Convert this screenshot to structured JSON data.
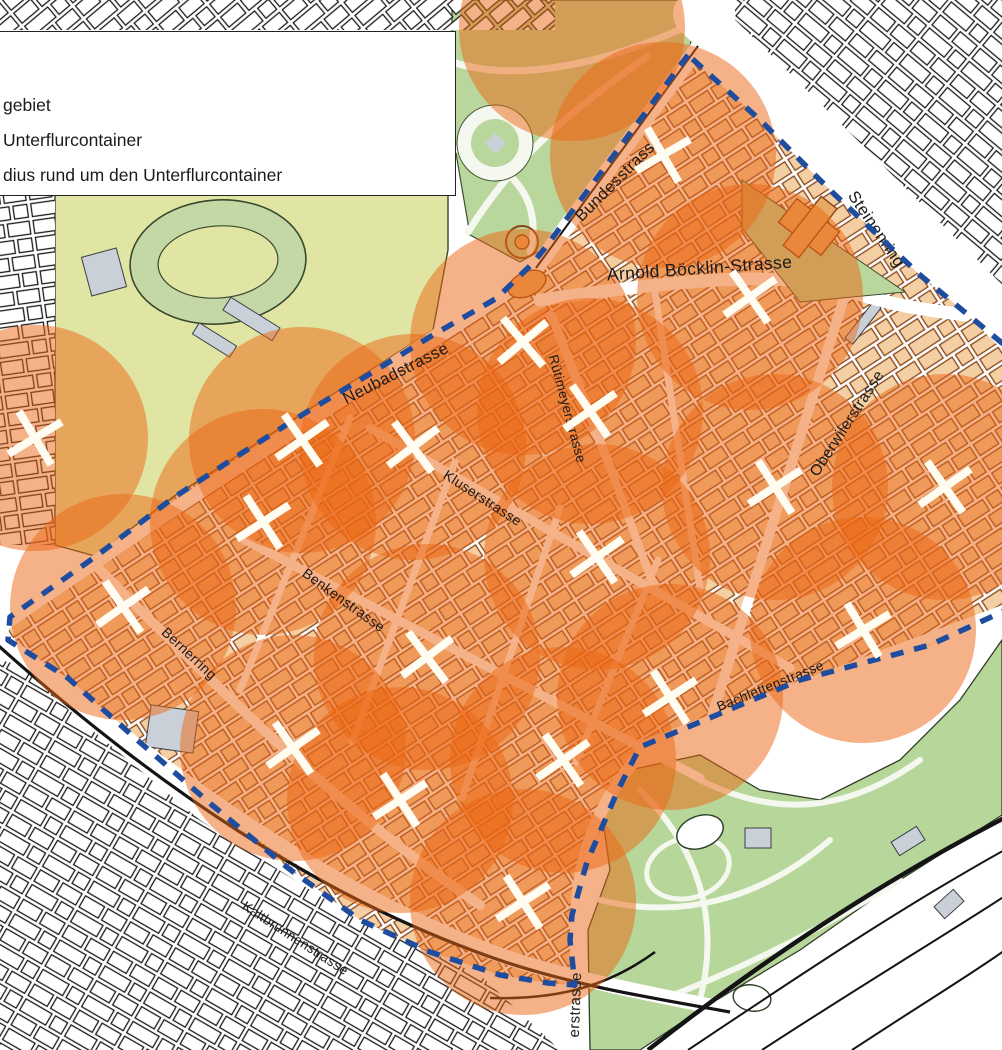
{
  "title": "Unterflurcontainer Pilotgebiet Karte",
  "legend": {
    "lines": [
      {
        "id": "pilot-area",
        "text": "gebiet"
      },
      {
        "id": "container",
        "text": "Unterflurcontainer"
      },
      {
        "id": "radius",
        "text": "dius rund um den Unterflurcontainer"
      }
    ]
  },
  "colors": {
    "circle_fill": "rgba(235,102,18,0.5)",
    "zone_building_fill": "#f3cfa3",
    "zone_building_stroke": "#8a4518",
    "outside_building_fill": "#ffffff",
    "outside_building_stroke": "#1a1a1a",
    "park_green": "#b9d79c",
    "zoo_green": "#b7d69a",
    "field_yellow": "#e0e5a3",
    "track_green": "#c3d8a4",
    "gray_building": "#c9d0d8",
    "boundary_blue": "#1e4da0",
    "marker_white": "#fffdf2",
    "rail_black": "#141414",
    "road_white": "#ffffff",
    "label_color": "#1a1a1a",
    "park_path": "#f4f8ee",
    "tan_feature": "#e9a963"
  },
  "map": {
    "canvas": {
      "w": 1002,
      "h": 1050
    },
    "circle_radius": 113,
    "patterns": [
      {
        "id": "pz",
        "rot": -33,
        "fill": "#f3cfa3",
        "stroke": "#8a4518"
      },
      {
        "id": "p1",
        "rot": -40,
        "fill": "#ffffff",
        "stroke": "#1a1a1a"
      },
      {
        "id": "p2",
        "rot": 40,
        "fill": "#ffffff",
        "stroke": "#1a1a1a"
      },
      {
        "id": "p3",
        "rot": 30,
        "fill": "#ffffff",
        "stroke": "#1a1a1a"
      },
      {
        "id": "p4",
        "rot": -8,
        "fill": "#ffffff",
        "stroke": "#1a1a1a"
      }
    ],
    "outside_regions": [
      {
        "pattern": "p1",
        "points": "0,0 555,0 555,30 0,30"
      },
      {
        "pattern": "p4",
        "points": "0,195 55,195 55,545 0,545"
      },
      {
        "pattern": "p2",
        "points": "735,0 1002,0 1002,325 920,238 830,155 760,85 735,30"
      },
      {
        "pattern": "p3",
        "points": "0,660 20,665 80,720 200,820 350,915 480,975 560,1050 0,1050"
      }
    ],
    "zone_points": "688,55 545,248 533,263 497,298 433,335 368,375 305,413 242,453 173,498 95,557 10,617 8,640 68,678 135,738 212,805 288,868 360,920 430,952 500,975 548,983 575,985 570,940 572,915 587,862 618,790 640,747 700,722 800,680 930,645 1002,612 1040,595 1040,320 1002,343 920,275 830,190 760,120",
    "field": {
      "points": "55,192 448,192 448,250 433,330 305,412 173,497 95,556 55,545",
      "track": {
        "cx": 218,
        "cy": 262,
        "rx": 88,
        "ry": 62,
        "rot": -4,
        "irx": 60,
        "iry": 36
      }
    },
    "park": {
      "points": "452,0 700,0 688,55 545,248 520,262 470,235 452,130",
      "paths": [
        "M452,62 C520,84 610,62 692,24",
        "M468,232 C512,162 560,118 648,56",
        "M452,148 C505,158 545,196 530,252",
        "M560,250 C600,180 640,120 688,60"
      ],
      "plaza": {
        "cx": 495,
        "cy": 143,
        "r": 38,
        "ir": 24
      }
    },
    "church_wedge": {
      "points": "742,180 905,292 800,302 742,228"
    },
    "church_rects": [
      {
        "x": 782,
        "y": 212,
        "w": 54,
        "h": 30,
        "rot": 38
      },
      {
        "x": 800,
        "y": 196,
        "w": 20,
        "h": 62,
        "rot": 38
      }
    ],
    "zoo": {
      "points": "590,1050 588,930 610,870 600,800 630,770 700,755 760,790 820,800 900,760 960,700 1002,640 1002,815 900,880 800,950 700,1010 640,1050",
      "paths": [
        "M640,790 C700,850 720,920 700,1000",
        "M600,900 C680,920 760,900 830,840",
        "M700,780 C780,820 850,810 920,760",
        "M660,1000 C740,970 820,930 900,880"
      ],
      "ring": {
        "cx": 688,
        "cy": 868,
        "rx": 42,
        "ry": 30,
        "rot": -15
      },
      "ponds": [
        {
          "cx": 700,
          "cy": 832,
          "rx": 24,
          "ry": 16,
          "rot": -20
        },
        {
          "cx": 752,
          "cy": 998,
          "rx": 19,
          "ry": 13,
          "rot": 10
        }
      ]
    },
    "gray_blocks": [
      {
        "x": 148,
        "y": 708,
        "w": 48,
        "h": 42,
        "rot": 8
      },
      {
        "x": 800,
        "y": 248,
        "w": 10,
        "h": 46,
        "rot": 38
      },
      {
        "x": 858,
        "y": 300,
        "w": 10,
        "h": 46,
        "rot": 38
      },
      {
        "x": 244,
        "y": 290,
        "w": 15,
        "h": 58,
        "rot": -58
      },
      {
        "x": 208,
        "y": 318,
        "w": 13,
        "h": 44,
        "rot": -58
      },
      {
        "x": 86,
        "y": 252,
        "w": 36,
        "h": 40,
        "rot": -15
      },
      {
        "x": 745,
        "y": 828,
        "w": 26,
        "h": 20,
        "rot": 0
      },
      {
        "x": 893,
        "y": 833,
        "w": 30,
        "h": 16,
        "rot": -32
      },
      {
        "x": 936,
        "y": 896,
        "w": 26,
        "h": 16,
        "rot": -42
      }
    ],
    "streets": [
      {
        "d": "M696,14 C790,105 900,215 1015,330",
        "w": 46
      },
      {
        "d": "M533,272 L700,45",
        "w": 16
      },
      {
        "d": "M533,272 C400,360 200,490 -8,632",
        "w": 14
      },
      {
        "d": "M540,300 C660,283 780,268 845,290 C900,308 930,310 965,315",
        "w": 13
      },
      {
        "d": "M552,316 L612,472",
        "w": 9
      },
      {
        "d": "M612,472 L655,590",
        "w": 8
      },
      {
        "d": "M845,295 L705,738",
        "w": 10
      },
      {
        "d": "M370,428 L790,668",
        "w": 9
      },
      {
        "d": "M245,540 L700,778",
        "w": 9
      },
      {
        "d": "M95,565 C230,700 340,810 480,905",
        "w": 10
      },
      {
        "d": "M645,745 L1010,608",
        "w": 11
      },
      {
        "d": "M652,742 C596,798 578,858 576,918 L576,1055",
        "w": 12
      },
      {
        "d": "M-8,630 C160,770 330,898 520,962 C580,980 640,992 720,1008",
        "w": 15
      },
      {
        "d": "M350,418 L240,690",
        "w": 7
      },
      {
        "d": "M455,462 L352,742",
        "w": 7
      },
      {
        "d": "M560,508 L462,798",
        "w": 7
      },
      {
        "d": "M658,560 L576,762",
        "w": 7
      },
      {
        "d": "M655,292 L700,588",
        "w": 7
      }
    ],
    "rails": [
      {
        "d": "M-8,640 C150,782 320,900 505,962 C575,985 640,996 730,1012",
        "w": 3.2
      },
      {
        "d": "M648,1050 C760,962 880,882 1008,816",
        "w": 4.5
      },
      {
        "d": "M688,1050 C800,975 905,905 1008,848",
        "w": 2
      },
      {
        "d": "M762,1050 C860,986 950,932 1008,894",
        "w": 2
      },
      {
        "d": "M852,1050 C925,1002 975,972 1008,948",
        "w": 2
      },
      {
        "d": "M536,268 L698,46",
        "w": 2
      },
      {
        "d": "M490,998 C560,1000 610,985 655,952",
        "w": 2.5
      }
    ],
    "junction_features": [
      {
        "type": "ring",
        "cx": 522,
        "cy": 242,
        "r": 16
      },
      {
        "type": "dot",
        "cx": 522,
        "cy": 242,
        "r": 7
      },
      {
        "type": "ellipse",
        "cx": 527,
        "cy": 284,
        "rx": 20,
        "ry": 12,
        "rot": -25
      }
    ],
    "circles": [
      {
        "x": 572,
        "y": 28
      },
      {
        "x": 663,
        "y": 155
      },
      {
        "x": 750,
        "y": 297
      },
      {
        "x": 523,
        "y": 342
      },
      {
        "x": 590,
        "y": 411
      },
      {
        "x": 413,
        "y": 447
      },
      {
        "x": 302,
        "y": 440
      },
      {
        "x": 263,
        "y": 522
      },
      {
        "x": 123,
        "y": 607
      },
      {
        "x": 35,
        "y": 438
      },
      {
        "x": 427,
        "y": 657
      },
      {
        "x": 597,
        "y": 557
      },
      {
        "x": 775,
        "y": 487
      },
      {
        "x": 945,
        "y": 487
      },
      {
        "x": 863,
        "y": 630
      },
      {
        "x": 670,
        "y": 697
      },
      {
        "x": 293,
        "y": 748
      },
      {
        "x": 400,
        "y": 800
      },
      {
        "x": 563,
        "y": 760
      },
      {
        "x": 523,
        "y": 902
      }
    ],
    "markers": [
      {
        "x": 663,
        "y": 155,
        "rot": 15
      },
      {
        "x": 750,
        "y": 297,
        "rot": 10
      },
      {
        "x": 523,
        "y": 342,
        "rot": 5
      },
      {
        "x": 590,
        "y": 411,
        "rot": 10
      },
      {
        "x": 413,
        "y": 447,
        "rot": 8
      },
      {
        "x": 302,
        "y": 440,
        "rot": 10
      },
      {
        "x": 263,
        "y": 522,
        "rot": 12
      },
      {
        "x": 123,
        "y": 607,
        "rot": 10
      },
      {
        "x": 35,
        "y": 438,
        "rot": 14
      },
      {
        "x": 427,
        "y": 657,
        "rot": 8
      },
      {
        "x": 597,
        "y": 557,
        "rot": 10
      },
      {
        "x": 775,
        "y": 487,
        "rot": 12
      },
      {
        "x": 945,
        "y": 487,
        "rot": 10
      },
      {
        "x": 863,
        "y": 630,
        "rot": 14
      },
      {
        "x": 670,
        "y": 697,
        "rot": 12
      },
      {
        "x": 293,
        "y": 748,
        "rot": 10
      },
      {
        "x": 400,
        "y": 800,
        "rot": 12
      },
      {
        "x": 563,
        "y": 760,
        "rot": 10
      },
      {
        "x": 523,
        "y": 902,
        "rot": 12
      }
    ],
    "street_labels": [
      {
        "id": "bundesstrasse",
        "text": "Bundesstrasse",
        "x": 622,
        "y": 182,
        "rot": -45,
        "size": 16.5
      },
      {
        "id": "arnold-boecklin-strasse",
        "text": "Arnold Böcklin-Strasse",
        "x": 700,
        "y": 274,
        "rot": -4,
        "size": 17.5
      },
      {
        "id": "steinenring",
        "text": "Steinenring",
        "x": 872,
        "y": 232,
        "rot": 56,
        "size": 16.5
      },
      {
        "id": "neubadstrasse",
        "text": "Neubadstrasse",
        "x": 398,
        "y": 378,
        "rot": -27,
        "size": 16.5
      },
      {
        "id": "ruetimeyerstrasse",
        "text": "Rütimeyerstrasse",
        "x": 563,
        "y": 410,
        "rot": 75,
        "size": 13.5
      },
      {
        "id": "kluserstrasse",
        "text": "Kluserstrasse",
        "x": 480,
        "y": 502,
        "rot": 33,
        "size": 14
      },
      {
        "id": "oberwilerstrasse",
        "text": "Oberwilerstrasse",
        "x": 851,
        "y": 426,
        "rot": -57,
        "size": 15.5
      },
      {
        "id": "benkenstrasse",
        "text": "Benkenstrasse",
        "x": 341,
        "y": 604,
        "rot": 36,
        "size": 14
      },
      {
        "id": "bernerring",
        "text": "Bernerring",
        "x": 186,
        "y": 657,
        "rot": 43,
        "size": 14
      },
      {
        "id": "bachlettenstrasse",
        "text": "Bachlettenstrasse",
        "x": 772,
        "y": 690,
        "rot": -22,
        "size": 13.5
      },
      {
        "id": "kaltbrunnenstrasse",
        "text": "Kaltbrunnenstrasse",
        "x": 293,
        "y": 942,
        "rot": 33,
        "size": 13.5
      },
      {
        "id": "erstrasse-partial",
        "text": "erstrasse",
        "x": 580,
        "y": 1005,
        "rot": -88,
        "size": 15
      }
    ],
    "boundary_points": "688,55 545,248 533,263 497,298 433,335 368,375 305,413 242,453 173,498 95,557 10,617 8,640 68,678 135,738 212,805 288,868 360,920 430,952 500,975 548,983 575,985 570,940 572,915 587,862 618,790 640,747 700,722 800,680 930,645 1002,612 1040,595 1040,320 1002,343 920,275 830,190 760,120 688,55"
  }
}
